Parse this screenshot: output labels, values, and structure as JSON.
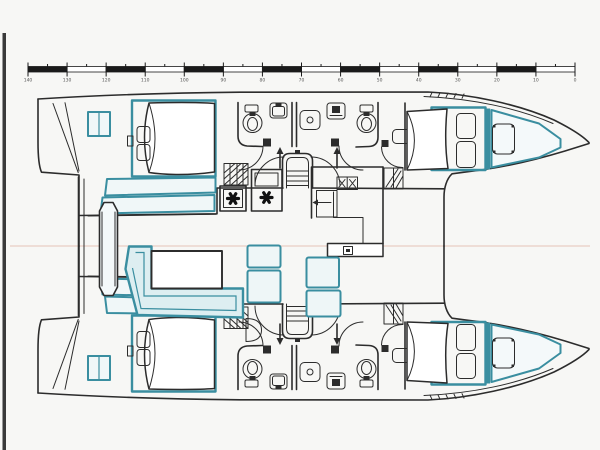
{
  "document": {
    "type": "catamaran-accommodation-plan",
    "description": "Top-down deck and accommodation layout drawing of a sailing catamaran; bows point right, sterns with swim platforms at left, saloon and cockpit on the bridgedeck between the two hulls",
    "visible_text": "no readable labels; only tiny numerals under the scale bar"
  },
  "scale_ruler": {
    "start_x": 28,
    "end_x": 575,
    "bar_y": 66.5,
    "bar_height": 5.5,
    "segments": 14,
    "tick_labels": [
      "140",
      "130",
      "120",
      "110",
      "100",
      "90",
      "80",
      "70",
      "60",
      "50",
      "40",
      "30",
      "20",
      "10",
      "0"
    ]
  },
  "colors": {
    "background": "#f7f7f5",
    "line": "#2c2c2c",
    "teal": "#3a8ea0",
    "tealFill": "#eaf4f6",
    "centerline": "#e9cdc3",
    "label": "#555555",
    "sheetEdge": "#3a3a3a"
  },
  "features": {
    "port_hull_top": [
      "transom-steps",
      "aft-double-berth",
      "berth-bench-steps",
      "wardrobe-cabinet",
      "aft-bathroom-toilet",
      "aft-bathroom-washbasin",
      "shared-shower",
      "forward-bathroom-washbasin",
      "forward-bathroom-toilet",
      "hull-stairs",
      "forward-double-berth",
      "watertight-bulkhead",
      "bow-locker-berth",
      "side-deck-hatch"
    ],
    "starboard_hull_bottom": [
      "transom-steps",
      "aft-double-berth",
      "berth-bench-steps",
      "wardrobe-cabinet",
      "aft-bathroom-toilet",
      "aft-bathroom-washbasin",
      "shared-shower",
      "forward-bathroom-washbasin",
      "forward-bathroom-toilet",
      "hull-stairs",
      "forward-double-berth",
      "watertight-bulkhead",
      "bow-locker-berth",
      "side-deck-hatch"
    ],
    "saloon": [
      "galley-counter",
      "galley-double-sink",
      "fridge-with-arrow",
      "galley-island",
      "stove-unit-two-burners",
      "companionway-steps-port",
      "companionway-steps-starboard",
      "dinette-table",
      "l-shaped-settee",
      "seat-cushions"
    ],
    "cockpit": [
      "aft-sliding-door-wall",
      "cockpit-table"
    ]
  }
}
